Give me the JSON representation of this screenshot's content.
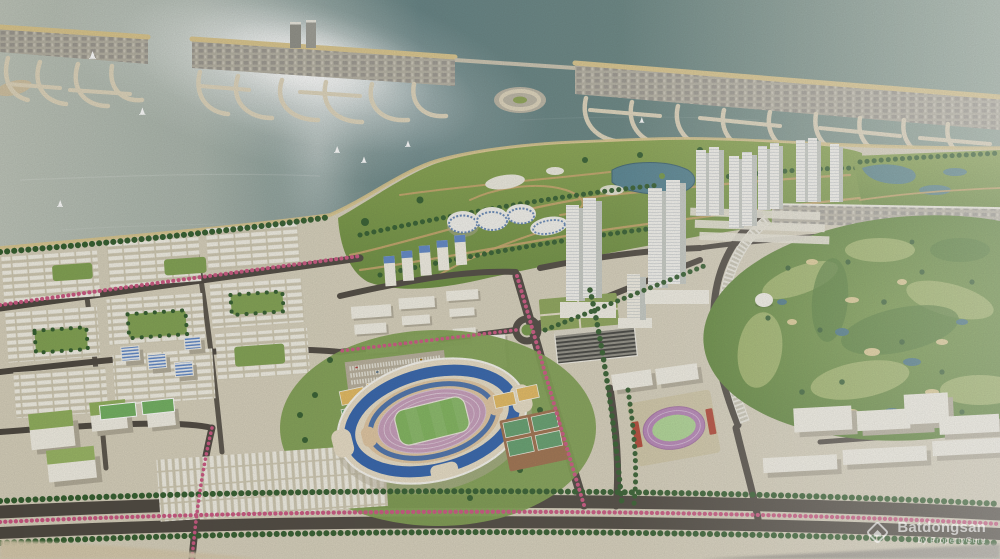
{
  "meta": {
    "kind": "aerial-3d-masterplan-rendering",
    "width": 1000,
    "height": 559
  },
  "watermark": {
    "brand": "Batdongsan",
    "byline": "by PropertyGuru",
    "logo": "diamond-house-icon"
  },
  "scene": {
    "landmarks": [
      "bay-water",
      "sun-glint",
      "island-peninsula-strip",
      "marina-fronds",
      "round-marina-island",
      "sailboats",
      "coastal-park",
      "park-lake",
      "round-pavilions",
      "highrise-tower-cluster",
      "midrise-district",
      "residential-grid",
      "blue-glass-buildings",
      "green-roof-buildings",
      "stadium",
      "running-track-field",
      "athletics-track",
      "tennis-courts",
      "parking-lot",
      "golf-course",
      "golf-clubhouse-dome",
      "flower-boulevards",
      "roundabout",
      "waterfront-slab-buildings"
    ]
  },
  "palette": {
    "waterSilver": "#bcc3b8",
    "waterTeal": "#5e7d7f",
    "waterRight": "#93a79b",
    "glint": "#ffffff",
    "sand": "#d9c48a",
    "strip": "#b0aca0",
    "frond": "#ddd3ba",
    "land": "#d6cfba",
    "park": "#7c9a44",
    "parkpath": "#c6a368",
    "tree": "#2f5a2a",
    "lake": "#51808f",
    "golf": "#618b3c",
    "golfLight": "#a3b768",
    "bunker": "#dcc98e",
    "pond": "#3f7080",
    "road": "#4a443c",
    "flower": "#c9537e",
    "bldg": "#f1eee3",
    "bldgshadow": "#b0a996",
    "blueGlass": "#5b84c6",
    "bowlTan": "#e7dcc4",
    "seatBlue": "#2d5faa",
    "trackPink": "#c49ab8",
    "pitchGreen": "#7cb258",
    "standRed": "#b2402f",
    "courtYellow": "#e3b85c",
    "courtGreen": "#5f9c6a",
    "courtPad": "#9c6d49"
  }
}
